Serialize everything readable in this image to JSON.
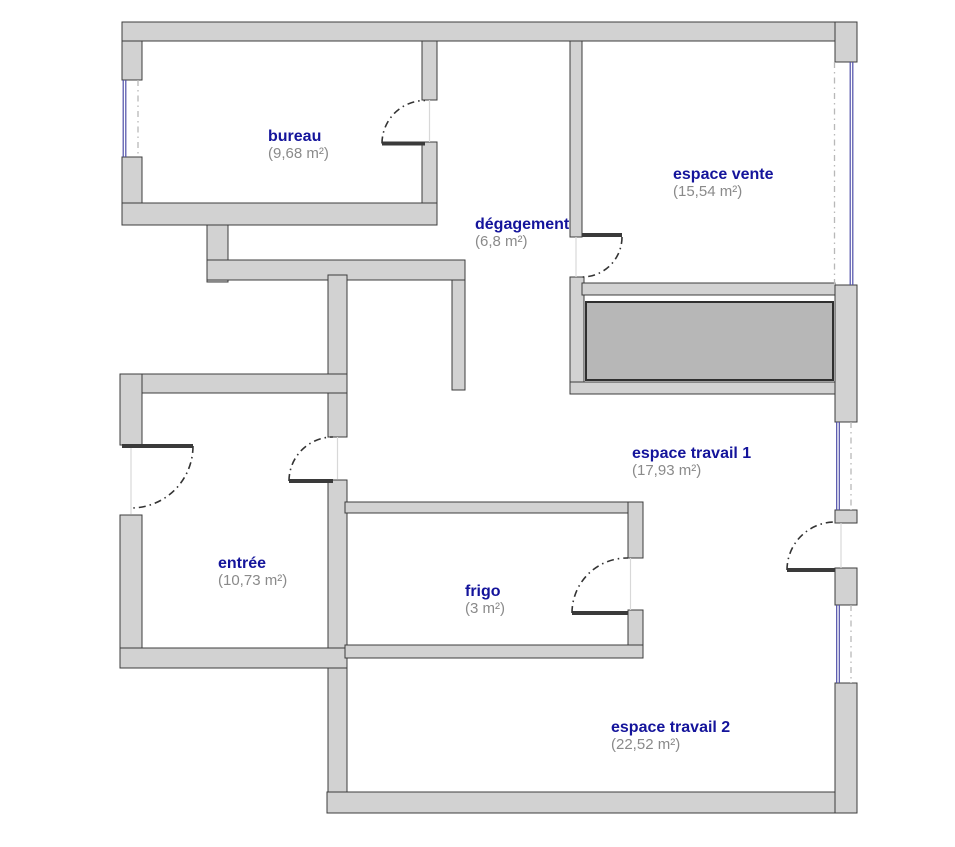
{
  "plan": {
    "canvas": {
      "width": 955,
      "height": 847,
      "background": "#ffffff"
    },
    "colors": {
      "wall_fill": "#d2d2d2",
      "wall_edge": "#3c3c3c",
      "block_fill": "#b7b7b7",
      "block_edge": "#2f2f2f",
      "room_name": "#14149b",
      "room_area": "#8a8a8a",
      "window_glass": "#4d4da8",
      "window_dash": "#b8b8b8",
      "door_arc": "#333333",
      "door_leaf": "#3a3a3a",
      "door_ghost": "#d8d8d8"
    },
    "rooms": [
      {
        "id": "bureau",
        "name": "bureau",
        "area": "(9,68 m²)",
        "x": 268,
        "y": 141
      },
      {
        "id": "espace-vente",
        "name": "espace vente",
        "area": "(15,54 m²)",
        "x": 673,
        "y": 179
      },
      {
        "id": "degagement",
        "name": "dégagement",
        "area": "(6,8 m²)",
        "x": 475,
        "y": 229
      },
      {
        "id": "espace-travail-1",
        "name": "espace travail 1",
        "area": "(17,93 m²)",
        "x": 632,
        "y": 458
      },
      {
        "id": "entree",
        "name": "entrée",
        "area": "(10,73 m²)",
        "x": 218,
        "y": 568
      },
      {
        "id": "frigo",
        "name": "frigo",
        "area": "(3 m²)",
        "x": 465,
        "y": 596
      },
      {
        "id": "espace-travail-2",
        "name": "espace travail 2",
        "area": "(22,52 m²)",
        "x": 611,
        "y": 732
      }
    ],
    "walls": [
      {
        "id": "top-wall",
        "r": [
          122,
          22,
          735,
          19
        ]
      },
      {
        "id": "bureau-left-upper",
        "r": [
          122,
          41,
          20,
          39
        ]
      },
      {
        "id": "bureau-left-lower",
        "r": [
          122,
          157,
          20,
          68
        ]
      },
      {
        "id": "bureau-bottom",
        "r": [
          122,
          203,
          315,
          22
        ]
      },
      {
        "id": "duct-vertical",
        "r": [
          207,
          225,
          21,
          57
        ]
      },
      {
        "id": "mid-horizontal",
        "r": [
          207,
          260,
          258,
          20
        ]
      },
      {
        "id": "corridor-right",
        "r": [
          452,
          280,
          13,
          110
        ]
      },
      {
        "id": "entree-right-upper",
        "r": [
          328,
          275,
          19,
          162
        ]
      },
      {
        "id": "travail2-left",
        "r": [
          328,
          480,
          19,
          333
        ]
      },
      {
        "id": "entree-top",
        "r": [
          120,
          374,
          227,
          19
        ]
      },
      {
        "id": "entree-left-upper",
        "r": [
          120,
          374,
          22,
          71
        ]
      },
      {
        "id": "entree-left-lower",
        "r": [
          120,
          515,
          22,
          152
        ]
      },
      {
        "id": "entree-bottom",
        "r": [
          120,
          648,
          227,
          20
        ]
      },
      {
        "id": "bottom-wall",
        "r": [
          327,
          792,
          530,
          21
        ]
      },
      {
        "id": "right-top-block",
        "r": [
          835,
          22,
          22,
          40
        ]
      },
      {
        "id": "right-mid-1",
        "r": [
          835,
          285,
          22,
          137
        ]
      },
      {
        "id": "right-mid-2",
        "r": [
          835,
          510,
          22,
          13
        ]
      },
      {
        "id": "right-mid-3",
        "r": [
          835,
          568,
          22,
          37
        ]
      },
      {
        "id": "right-bottom",
        "r": [
          835,
          683,
          22,
          130
        ]
      },
      {
        "id": "bureau-right-upper",
        "r": [
          422,
          41,
          15,
          59
        ]
      },
      {
        "id": "bureau-right-lower",
        "r": [
          422,
          142,
          15,
          61
        ]
      },
      {
        "id": "vente-left-upper",
        "r": [
          570,
          41,
          12,
          196
        ]
      },
      {
        "id": "vente-left-lower",
        "r": [
          570,
          277,
          14,
          116
        ]
      },
      {
        "id": "vente-bottom",
        "r": [
          582,
          283,
          253,
          12
        ]
      },
      {
        "id": "below-block-wall",
        "r": [
          570,
          382,
          265,
          12
        ]
      },
      {
        "id": "frigo-top",
        "r": [
          345,
          502,
          298,
          11
        ]
      },
      {
        "id": "frigo-right-upper",
        "r": [
          628,
          502,
          15,
          56
        ]
      },
      {
        "id": "frigo-right-lower",
        "r": [
          628,
          610,
          15,
          48
        ]
      },
      {
        "id": "frigo-bottom",
        "r": [
          345,
          645,
          298,
          13
        ]
      }
    ],
    "shaded_block": {
      "id": "shaded-block",
      "r": [
        586,
        302,
        247,
        78
      ]
    },
    "windows": [
      {
        "id": "bureau-window",
        "glass": [
          124.5,
          80,
          124.5,
          157
        ],
        "dash": [
          138,
          80,
          138,
          157
        ]
      },
      {
        "id": "vente-window",
        "glass": [
          851.5,
          62,
          851.5,
          285
        ],
        "dash": [
          834.5,
          62,
          834.5,
          285
        ]
      },
      {
        "id": "travail1-window",
        "glass": [
          838,
          422,
          838,
          510
        ],
        "dash": [
          851,
          422,
          851,
          510
        ]
      },
      {
        "id": "travail2-window",
        "glass": [
          838,
          605,
          838,
          683
        ],
        "dash": [
          851,
          605,
          851,
          683
        ]
      }
    ],
    "doors": [
      {
        "id": "bureau-door",
        "leaf": [
          425,
          143.5,
          382,
          143.5
        ],
        "arc": "M 382 143.5 A 43 43 0 0 1 425 100.5",
        "ghost": [
          429.5,
          100,
          429.5,
          142
        ]
      },
      {
        "id": "vente-door",
        "leaf": [
          582,
          235,
          622,
          235
        ],
        "arc": "M 622 237 A 40 40 0 0 1 582 277",
        "ghost": [
          576,
          237,
          576,
          277
        ]
      },
      {
        "id": "front-door",
        "leaf": [
          122,
          446,
          193,
          446
        ],
        "arc": "M 193 446 A 62 62 0 0 1 131 508",
        "ghost": [
          131,
          448,
          131,
          514
        ]
      },
      {
        "id": "entree-inner-door",
        "leaf": [
          333,
          481,
          289,
          481
        ],
        "arc": "M 289 481 A 44 44 0 0 1 333 437",
        "ghost": [
          337.5,
          437,
          337.5,
          479
        ]
      },
      {
        "id": "frigo-door",
        "leaf": [
          628,
          613,
          572,
          613
        ],
        "arc": "M 572 613 A 55 55 0 0 1 628 558",
        "ghost": [
          630.5,
          558,
          630.5,
          610
        ]
      },
      {
        "id": "travail-right-door",
        "leaf": [
          835,
          570,
          787,
          570
        ],
        "arc": "M 787 570 A 48 48 0 0 1 835 522",
        "ghost": [
          841,
          523,
          841,
          568
        ]
      }
    ]
  }
}
